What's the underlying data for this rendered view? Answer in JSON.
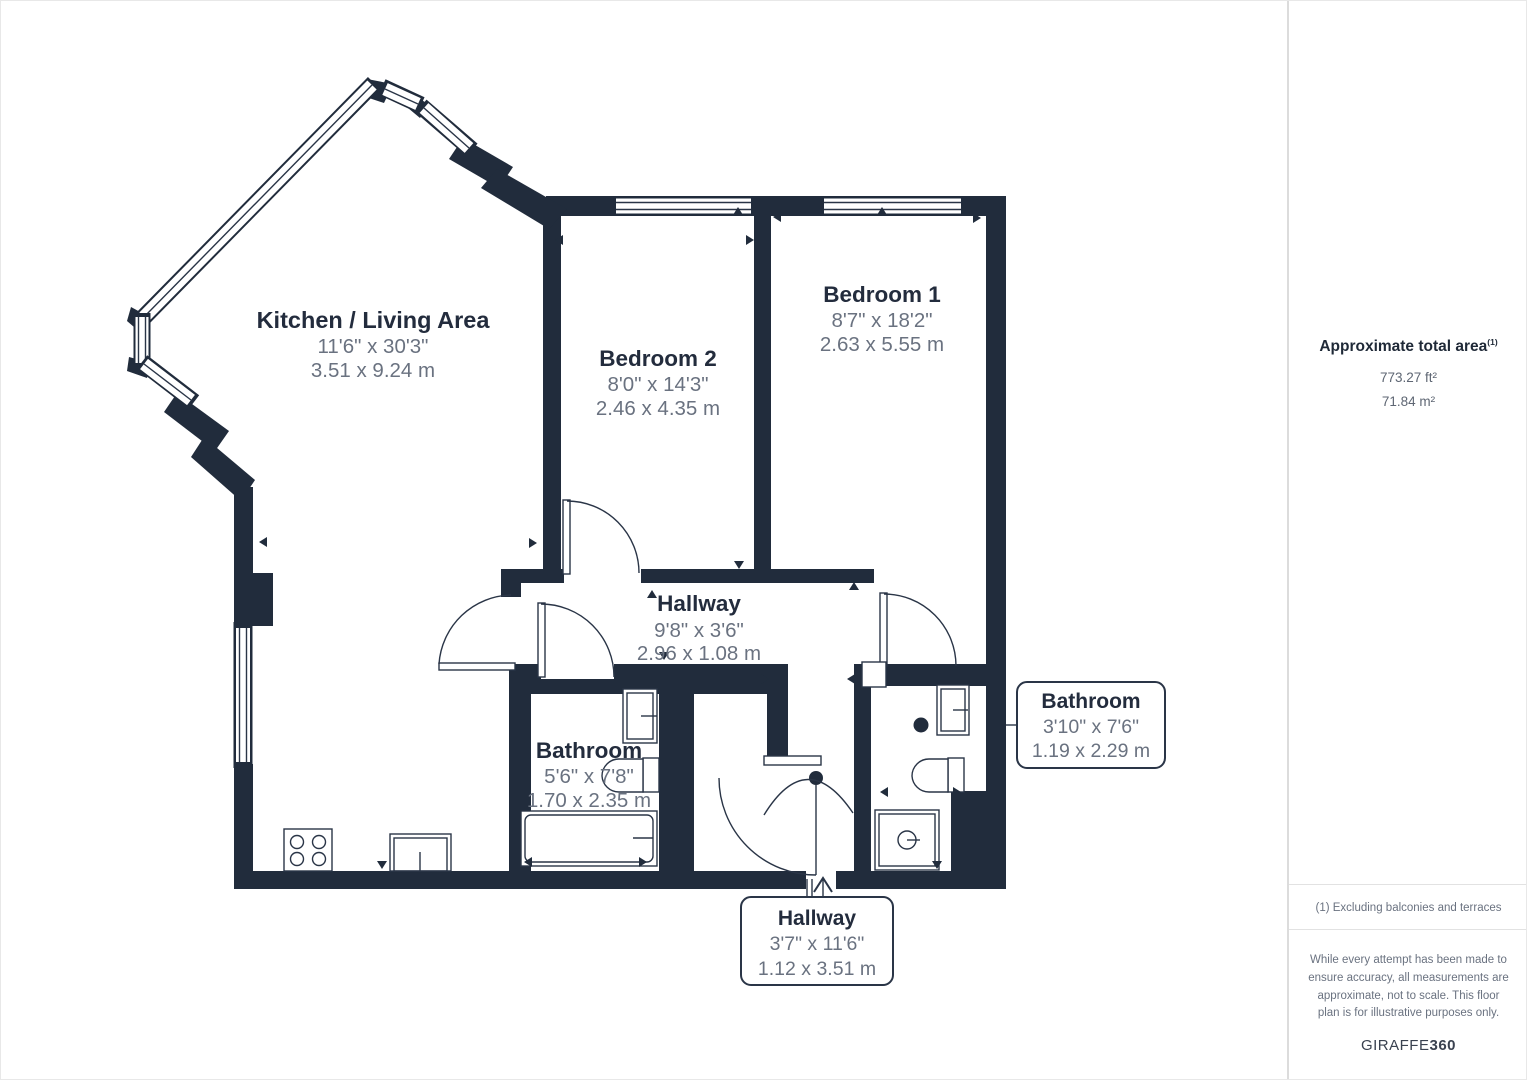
{
  "plan": {
    "rooms": [
      {
        "name": "Kitchen / Living Area",
        "imperial": "11'6\" x 30'3\"",
        "metric": "3.51 x 9.24 m"
      },
      {
        "name": "Bedroom 2",
        "imperial": "8'0\" x 14'3\"",
        "metric": "2.46 x 4.35 m"
      },
      {
        "name": "Bedroom 1",
        "imperial": "8'7\" x 18'2\"",
        "metric": "2.63 x 5.55 m"
      },
      {
        "name": "Hallway",
        "imperial": "9'8\" x 3'6\"",
        "metric": "2.96 x 1.08 m"
      },
      {
        "name": "Bathroom",
        "imperial": "5'6\" x 7'8\"",
        "metric": "1.70 x 2.35 m"
      },
      {
        "name": "Bathroom",
        "imperial": "3'10\" x 7'6\"",
        "metric": "1.19 x 2.29 m"
      },
      {
        "name": "Hallway",
        "imperial": "3'7\" x 11'6\"",
        "metric": "1.12 x 3.51 m"
      }
    ],
    "colors": {
      "wall": "#212C3C",
      "label": "#232C3D",
      "dimension": "#6A7280"
    }
  },
  "sidebar": {
    "title": "Approximate total area",
    "title_sup": "(1)",
    "area_ft": "773.27 ft²",
    "area_m": "71.84 m²",
    "footnote": "(1) Excluding balconies and terraces",
    "disclaimer": "While every attempt has been made to ensure accuracy, all measurements are approximate, not to scale. This floor plan is for illustrative purposes only.",
    "brand": "GIRAFFE",
    "brand_suffix": "360"
  }
}
